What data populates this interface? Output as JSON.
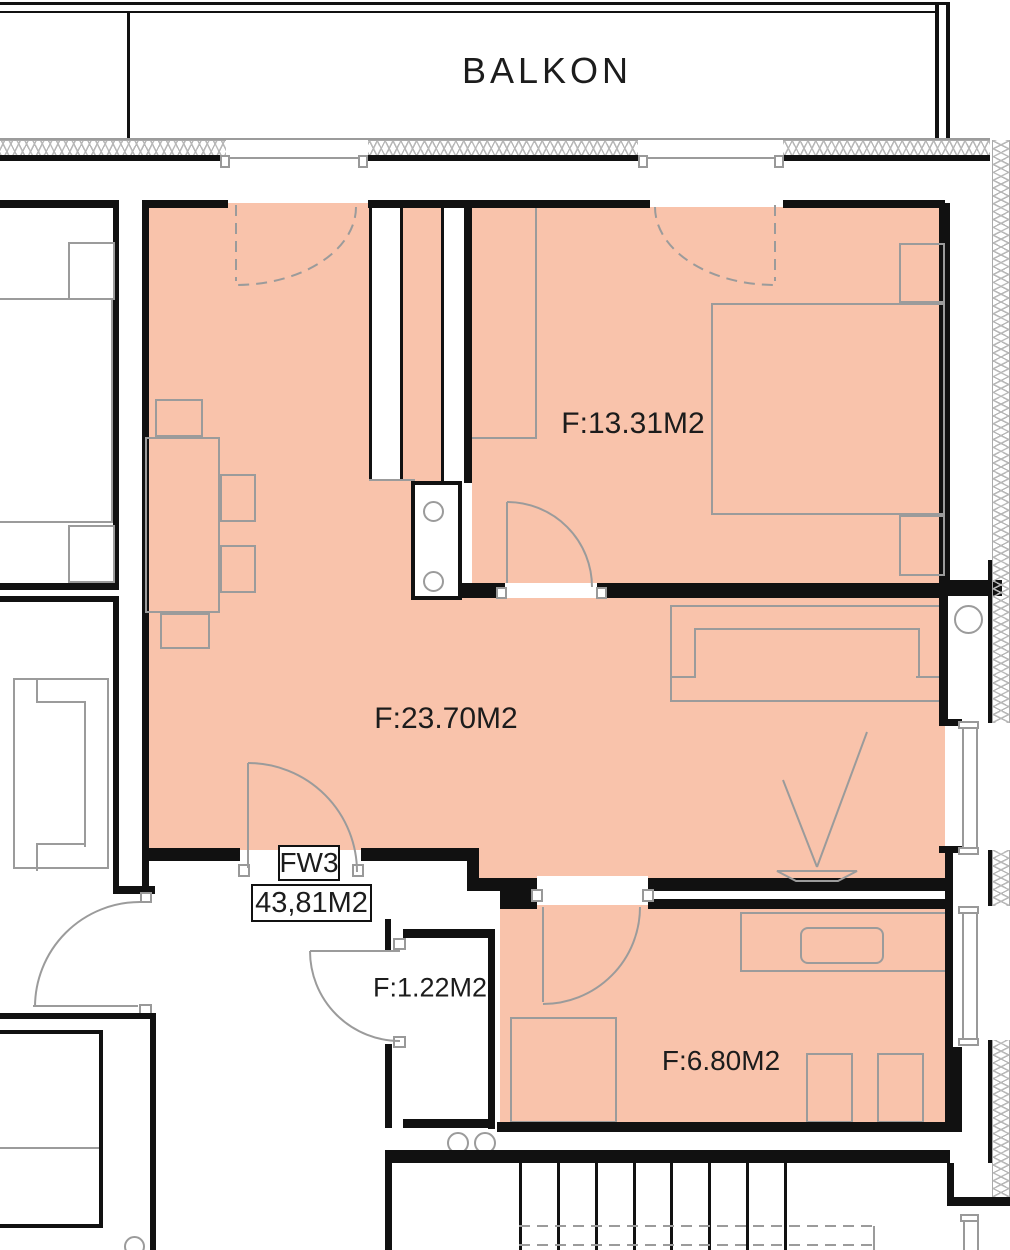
{
  "balcony": {
    "label": "BALKON"
  },
  "apartment": {
    "id": "FW3",
    "total_area": "43,81M2"
  },
  "rooms": [
    {
      "name": "bedroom",
      "area_label": "F:13.31M2"
    },
    {
      "name": "living-room",
      "area_label": "F:23.70M2"
    },
    {
      "name": "hall-closet",
      "area_label": "F:1.22M2"
    },
    {
      "name": "small-room",
      "area_label": "F:6.80M2"
    }
  ],
  "colors": {
    "highlight_fill": "#f9c3ab",
    "wall": "#111111",
    "furniture_line": "#9b9b9b",
    "hatch_line": "#b8b8b8",
    "text": "#1c1c1c"
  }
}
